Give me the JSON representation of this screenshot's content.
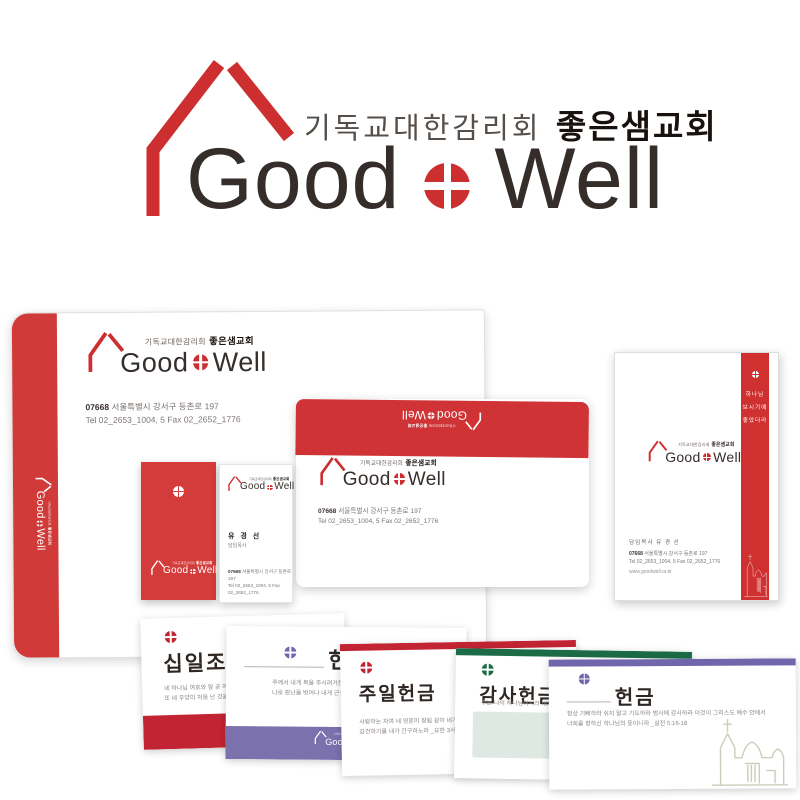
{
  "brand": {
    "affiliation": "기독교대한감리회",
    "church_name": "좋은샘교회",
    "wordmark_left": "Good",
    "wordmark_right": "Well",
    "colors": {
      "brand_red": "#cd2e30",
      "bar_red": "#c32433",
      "green": "#1c6b47",
      "purple": "#6f66ab",
      "band_purple": "#7a71ad",
      "light_green_box": "#dfe9e3",
      "dark_text": "#332b29"
    }
  },
  "contact": {
    "zip": "07668",
    "address": "서울특별시 강서구 등촌로 197",
    "tel_fax": "Tel 02_2653_1004, 5  Fax 02_2652_1776",
    "website": "www.goodwell.or.kr",
    "pastor_line": "담임목사 유 경 선"
  },
  "business_card": {
    "name": "유 경 선",
    "title": "담임목사"
  },
  "letterhead": {
    "verse_line1": "하나님",
    "verse_line2": "보시기에",
    "verse_line3": "좋았더라"
  },
  "offering_envelopes": [
    {
      "title": "십일조",
      "verse1": "네 하나님 여호와 앞 곧 여호와께서",
      "verse2": "또 네 우양의 처음 난 것을 먹고 네",
      "accent": "#c32433"
    },
    {
      "title": "헌금",
      "verse1": "주께서 내게 복을 주시려거든 나의 지역을 넓히시고 주의",
      "verse2": "나로 환난을 벗어나 내게 근심이 없게 하옵소서 _역대상 4:10",
      "accent": "#6f66ab"
    },
    {
      "title": "주일헌금",
      "verse1": "사랑하는 자여 네 영혼이 잘됨 같이 네가 범사에 잘되고",
      "verse2": "강건하기를 내가 간구하노라 _요한 3서 1장 2절",
      "accent": "#c32433"
    },
    {
      "title": "감사헌금",
      "verse1": "주는 나의 하나님이시라 내가 주께 감사하리이다",
      "verse2": "",
      "accent": "#1c6b47"
    },
    {
      "title": "헌금",
      "verse1": "항상 기뻐하라 쉬지 말고 기도하라 범사에 감사하라 이것이 그리스도 예수 안에서",
      "verse2": "너희를 향하신 하나님의 뜻이니라 _살전 5:16-18",
      "accent": "#6f66ab"
    }
  ]
}
